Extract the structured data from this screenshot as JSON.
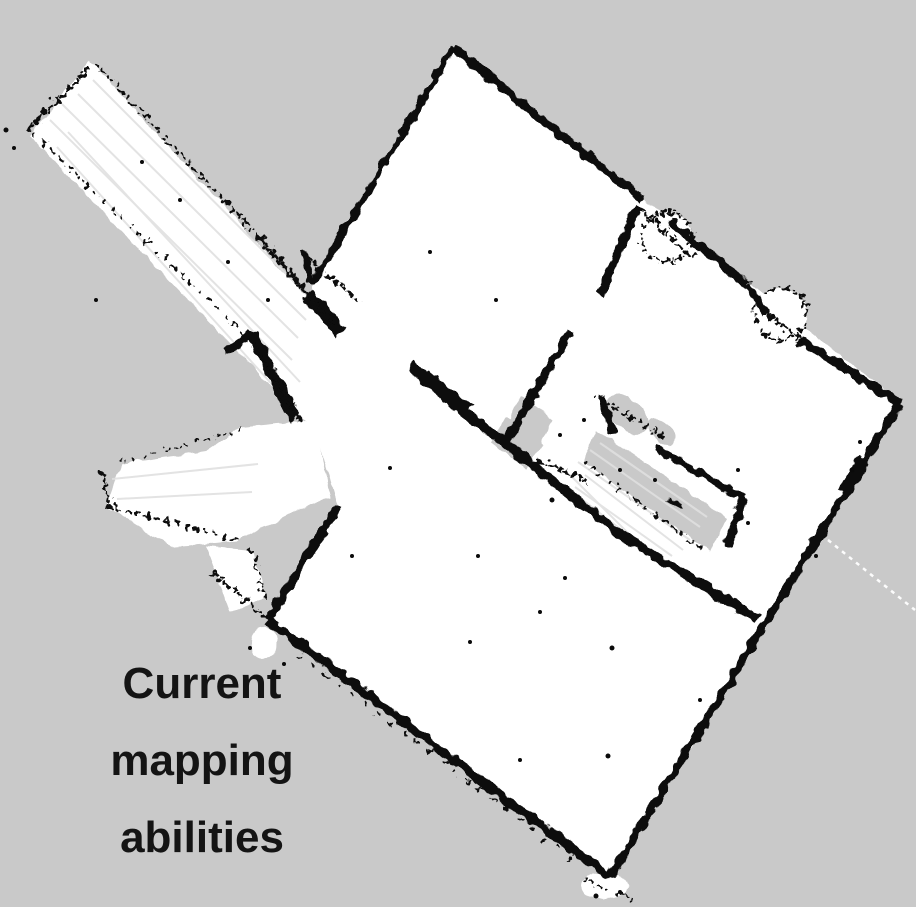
{
  "figure": {
    "kind": "occupancy-grid-slam-map",
    "annotation_lines": [
      "Current",
      "mapping",
      "abilities"
    ]
  },
  "colors": {
    "background": "#c9c9c9",
    "unknown_space": "#c9c9c9",
    "free_space": "#ffffff",
    "occupied_walls": "#0a0a0a",
    "laser_rays": "#e0e0e0",
    "ray_trace_line": "#ffffff",
    "annotation_text": "#141414"
  }
}
